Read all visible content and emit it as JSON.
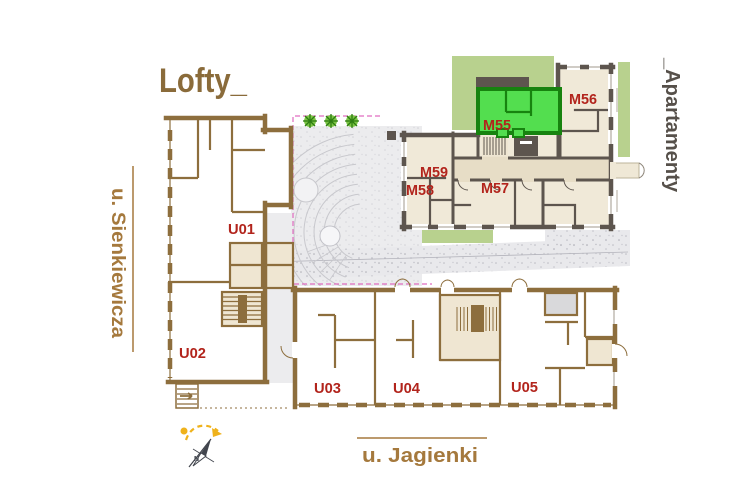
{
  "plan": {
    "lofty_title": "Lofty_",
    "apartamenty_title": "_Apartamenty",
    "street_left": "u. Sienkiewicza",
    "street_bottom": "u. Jagienki",
    "compass_north": "N",
    "highlighted_unit": "M55"
  },
  "lofty_units": {
    "u01": "U01",
    "u02": "U02",
    "u03": "U03",
    "u04": "U04",
    "u05": "U05"
  },
  "apartment_units": {
    "m55": "M55",
    "m56": "M56",
    "m57": "M57",
    "m58": "M58",
    "m59": "M59"
  },
  "colors": {
    "lofty_wall_brown": "#8d6e3d",
    "apartment_wall_gray": "#5d554e",
    "highlight_green_fill": "#53de4f",
    "highlight_green_wall": "#17830f",
    "unit_label_red": "#b2241c",
    "landscape_green": "#b8d18e",
    "street_text_brown": "#a5793d",
    "guide_pink": "#e06cc0",
    "compass_yellow": "#efb21c"
  }
}
